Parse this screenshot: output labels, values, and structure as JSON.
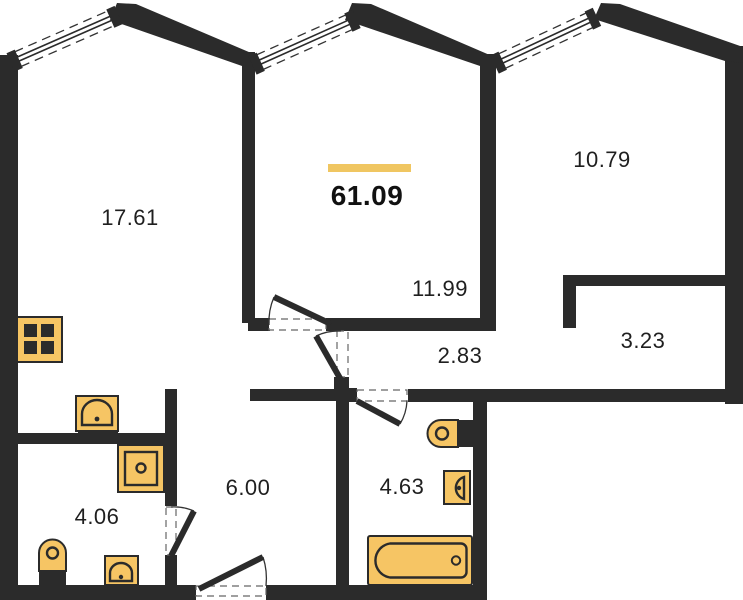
{
  "total_area": {
    "value": "61.09"
  },
  "rooms": [
    {
      "name": "living-kitchen-room",
      "area": "17.61"
    },
    {
      "name": "room-center",
      "area": "11.99"
    },
    {
      "name": "room-right",
      "area": "10.79"
    },
    {
      "name": "wardrobe-niche",
      "area": "3.23"
    },
    {
      "name": "hallway",
      "area": "2.83"
    },
    {
      "name": "corridor",
      "area": "6.00"
    },
    {
      "name": "bathroom-small",
      "area": "4.06"
    },
    {
      "name": "bathroom-large",
      "area": "4.63"
    }
  ],
  "features": {
    "windows": 3,
    "doors": 5
  },
  "fixtures": {
    "kitchen": [
      "stove-icon",
      "sink-icon"
    ],
    "bathroom_small": [
      "washing-machine-icon",
      "toilet-icon",
      "sink-icon"
    ],
    "bathroom_large": [
      "toilet-icon",
      "sink-icon",
      "bathtub-icon"
    ]
  },
  "colors": {
    "wall": "#2b2b2b",
    "ink": "#1f1f1f",
    "fixture": "#f6c564",
    "accent": "#f0c661",
    "dash": "#666666",
    "arc": "#333333",
    "bg": "#ffffff"
  }
}
